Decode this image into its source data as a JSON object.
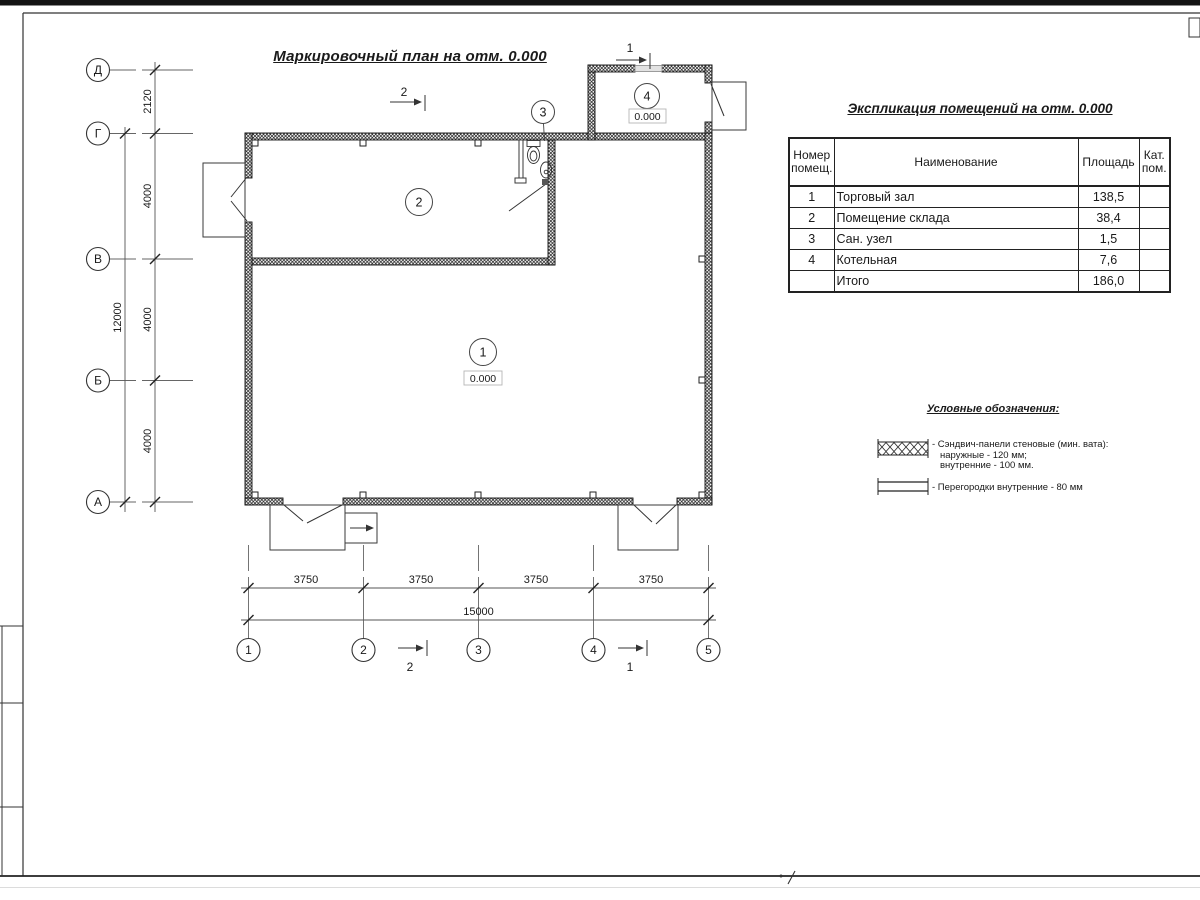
{
  "sheet": {
    "page_mark": "7"
  },
  "plan": {
    "title": "Маркировочный план на отм. 0.000",
    "rooms": [
      {
        "number": "1",
        "elevation": "0.000"
      },
      {
        "number": "2",
        "elevation": ""
      },
      {
        "number": "3",
        "elevation": ""
      },
      {
        "number": "4",
        "elevation": "0.000"
      }
    ],
    "section_labels": {
      "s1": "1",
      "s2": "2"
    }
  },
  "axes": {
    "vertical": [
      "Д",
      "Г",
      "В",
      "Б",
      "А"
    ],
    "horizontal": [
      "1",
      "2",
      "3",
      "4",
      "5"
    ]
  },
  "dimensions": {
    "left_segments": [
      "2120",
      "4000",
      "4000",
      "4000"
    ],
    "left_total": "12000",
    "bottom_segments": [
      "3750",
      "3750",
      "3750",
      "3750"
    ],
    "bottom_total": "15000"
  },
  "schedule": {
    "title": "Экспликация помещений на отм. 0.000",
    "columns": {
      "number": "Номер помещ.",
      "name": "Наименование",
      "area": "Площадь",
      "category": "Кат. пом."
    },
    "rows": [
      {
        "num": "1",
        "name": "Торговый зал",
        "area": "138,5",
        "cat": ""
      },
      {
        "num": "2",
        "name": "Помещение склада",
        "area": "38,4",
        "cat": ""
      },
      {
        "num": "3",
        "name": "Сан. узел",
        "area": "1,5",
        "cat": ""
      },
      {
        "num": "4",
        "name": "Котельная",
        "area": "7,6",
        "cat": ""
      },
      {
        "num": "",
        "name": "Итого",
        "area": "186,0",
        "cat": ""
      }
    ]
  },
  "legend": {
    "title": "Условные обозначения:",
    "item1_line1": "- Сэндвич-панели стеновые (мин. вата):",
    "item1_line2": "наружные - 120 мм;",
    "item1_line3": "внутренние - 100 мм.",
    "item2_line1": "- Перегородки внутренние - 80 мм"
  }
}
